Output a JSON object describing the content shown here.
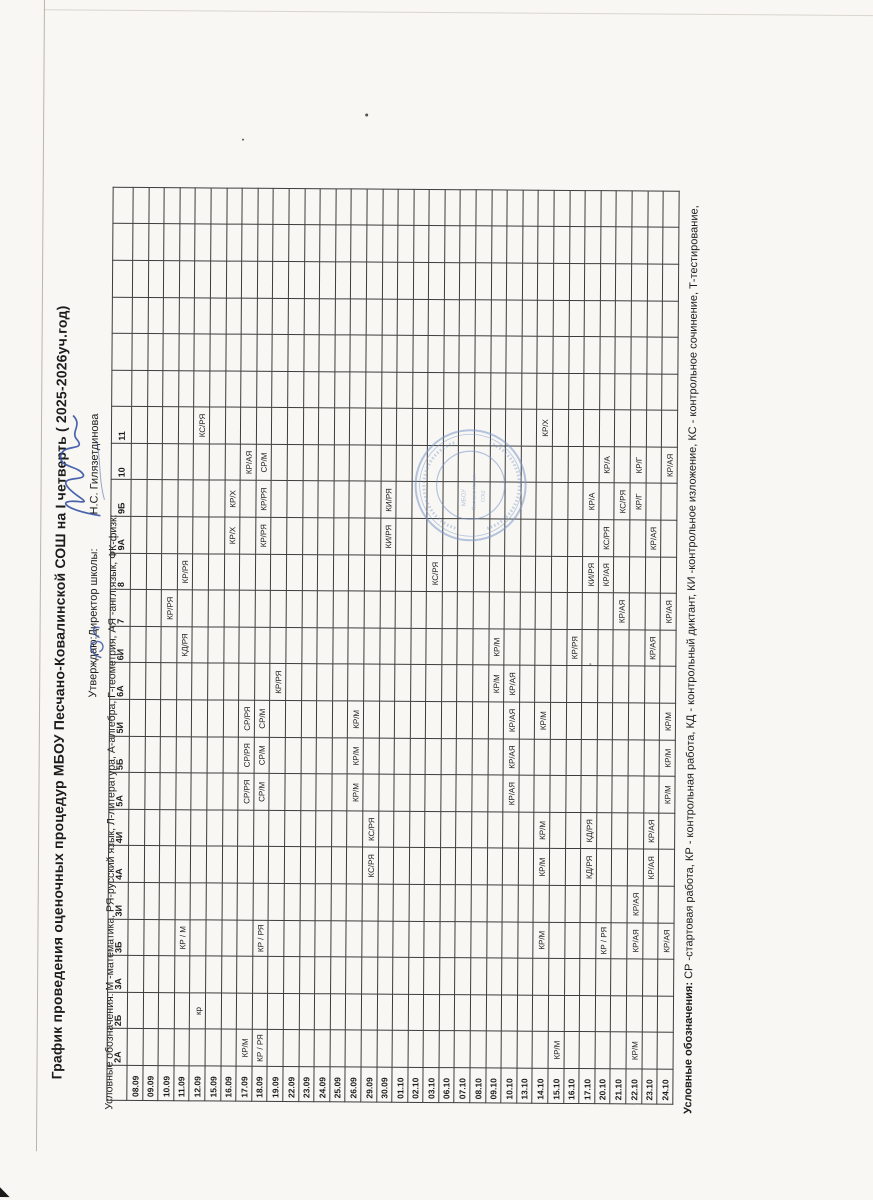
{
  "title": "График проведения оценочных процедур МБОУ Песчано-Ковалинской СОШ на I четверть ( 2025-2026уч.год)",
  "approval": {
    "prefix": "Утверждаю:Директор школы:",
    "name": "Н.С. Гилязетдинова"
  },
  "legend_top": "Условные обозначения: М -математика, РЯ-русский язык, Л-литература, А-алгебра, Г-геометрия, АЯ -англ.язык, ФК-физк:",
  "legend_bottom_bold": "Условные обозначения:",
  "legend_bottom_rest": " СР -стартовая работа, КР - контрольная работа, КД - контрольный диктант, КИ -контрольное изложение, КС - контрольное сочинение, Т-тестирование,",
  "classes": [
    "2А",
    "2Б",
    "3А",
    "3Б",
    "3И",
    "4А",
    "4И",
    "5А",
    "5Б",
    "5И",
    "6А",
    "6И",
    "7",
    "8",
    "9А",
    "9Б",
    "10",
    "11"
  ],
  "empty_trailing_columns": 6,
  "dates": [
    "08.09",
    "09.09",
    "10.09",
    "11.09",
    "12.09",
    "15.09",
    "16.09",
    "17.09",
    "18.09",
    "19.09",
    "22.09",
    "23.09",
    "24.09",
    "25.09",
    "26.09",
    "29.09",
    "30.09",
    "01.10",
    "02.10",
    "03.10",
    "06.10",
    "07.10",
    "08.10",
    "09.10",
    "10.10",
    "13.10",
    "14.10",
    "15.10",
    "16.10",
    "17.10",
    "20.10",
    "21.10",
    "22.10",
    "23.10",
    "24.10"
  ],
  "entries": [
    {
      "date": "10.09",
      "class": "7",
      "value": "КР/РЯ"
    },
    {
      "date": "11.09",
      "class": "3Б",
      "value": "КР / М"
    },
    {
      "date": "11.09",
      "class": "6И",
      "value": "КД/РЯ"
    },
    {
      "date": "11.09",
      "class": "8",
      "value": "КР/РЯ"
    },
    {
      "date": "12.09",
      "class": "2Б",
      "value": "кр"
    },
    {
      "date": "12.09",
      "class": "11",
      "value": "КС/РЯ"
    },
    {
      "date": "16.09",
      "class": "9А",
      "value": "КР/Х"
    },
    {
      "date": "16.09",
      "class": "9Б",
      "value": "КР/Х"
    },
    {
      "date": "17.09",
      "class": "2А",
      "value": "КР/М"
    },
    {
      "date": "17.09",
      "class": "5А",
      "value": "СР/РЯ"
    },
    {
      "date": "17.09",
      "class": "5Б",
      "value": "СР/РЯ"
    },
    {
      "date": "17.09",
      "class": "5И",
      "value": "СР/РЯ"
    },
    {
      "date": "17.09",
      "class": "10",
      "value": "КР/АЯ"
    },
    {
      "date": "18.09",
      "class": "2А",
      "value": "КР / РЯ"
    },
    {
      "date": "18.09",
      "class": "3Б",
      "value": "КР / РЯ"
    },
    {
      "date": "18.09",
      "class": "5А",
      "value": "СР/М"
    },
    {
      "date": "18.09",
      "class": "5Б",
      "value": "СР/М"
    },
    {
      "date": "18.09",
      "class": "5И",
      "value": "СР/М"
    },
    {
      "date": "18.09",
      "class": "9А",
      "value": "КР/РЯ"
    },
    {
      "date": "18.09",
      "class": "9Б",
      "value": "КР/РЯ"
    },
    {
      "date": "18.09",
      "class": "10",
      "value": "СР/М"
    },
    {
      "date": "19.09",
      "class": "6А",
      "value": "КР/РЯ"
    },
    {
      "date": "26.09",
      "class": "5А",
      "value": "КР/М"
    },
    {
      "date": "26.09",
      "class": "5Б",
      "value": "КР/М"
    },
    {
      "date": "26.09",
      "class": "5И",
      "value": "КР/М"
    },
    {
      "date": "29.09",
      "class": "4А",
      "value": "КС/РЯ"
    },
    {
      "date": "29.09",
      "class": "4И",
      "value": "КС/РЯ"
    },
    {
      "date": "30.09",
      "class": "9А",
      "value": "КИ/РЯ"
    },
    {
      "date": "30.09",
      "class": "9Б",
      "value": "КИ/РЯ"
    },
    {
      "date": "03.10",
      "class": "8",
      "value": "КС/РЯ"
    },
    {
      "date": "09.10",
      "class": "6А",
      "value": "КР/М"
    },
    {
      "date": "09.10",
      "class": "6И",
      "value": "КР/М"
    },
    {
      "date": "10.10",
      "class": "5А",
      "value": "КР/АЯ"
    },
    {
      "date": "10.10",
      "class": "5Б",
      "value": "КР/АЯ"
    },
    {
      "date": "10.10",
      "class": "5И",
      "value": "КР/АЯ"
    },
    {
      "date": "10.10",
      "class": "6А",
      "value": "КР/АЯ"
    },
    {
      "date": "14.10",
      "class": "3Б",
      "value": "КР/М"
    },
    {
      "date": "14.10",
      "class": "4А",
      "value": "КР/М"
    },
    {
      "date": "14.10",
      "class": "4И",
      "value": "КР/М"
    },
    {
      "date": "14.10",
      "class": "5И",
      "value": "КР/М"
    },
    {
      "date": "14.10",
      "class": "11",
      "value": "КР/Х"
    },
    {
      "date": "15.10",
      "class": "2А",
      "value": "КР/М"
    },
    {
      "date": "16.10",
      "class": "6И",
      "value": "КР/РЯ"
    },
    {
      "date": "17.10",
      "class": "4А",
      "value": "КД/РЯ"
    },
    {
      "date": "17.10",
      "class": "4И",
      "value": "КД/РЯ"
    },
    {
      "date": "17.10",
      "class": "8",
      "value": "КИ/РЯ"
    },
    {
      "date": "17.10",
      "class": "9Б",
      "value": "КР/А"
    },
    {
      "date": "20.10",
      "class": "3Б",
      "value": "КР / РЯ"
    },
    {
      "date": "20.10",
      "class": "8",
      "value": "КР/АЯ"
    },
    {
      "date": "20.10",
      "class": "9А",
      "value": "КС/РЯ"
    },
    {
      "date": "20.10",
      "class": "10",
      "value": "КР/А"
    },
    {
      "date": "21.10",
      "class": "7",
      "value": "КР/АЯ"
    },
    {
      "date": "21.10",
      "class": "9Б",
      "value": "КС/РЯ"
    },
    {
      "date": "22.10",
      "class": "2А",
      "value": "КР/М"
    },
    {
      "date": "22.10",
      "class": "3Б",
      "value": "КР/АЯ"
    },
    {
      "date": "22.10",
      "class": "3И",
      "value": "КР/АЯ"
    },
    {
      "date": "22.10",
      "class": "9Б",
      "value": "КР/Г"
    },
    {
      "date": "22.10",
      "class": "10",
      "value": "КР/Г"
    },
    {
      "date": "23.10",
      "class": "4А",
      "value": "КР/АЯ"
    },
    {
      "date": "23.10",
      "class": "4И",
      "value": "КР/АЯ"
    },
    {
      "date": "23.10",
      "class": "6И",
      "value": "КР/АЯ"
    },
    {
      "date": "23.10",
      "class": "9А",
      "value": "КР/АЯ"
    },
    {
      "date": "24.10",
      "class": "3Б",
      "value": "КР/АЯ"
    },
    {
      "date": "24.10",
      "class": "5А",
      "value": "КР/М"
    },
    {
      "date": "24.10",
      "class": "5Б",
      "value": "КР/М"
    },
    {
      "date": "24.10",
      "class": "5И",
      "value": "КР/М"
    },
    {
      "date": "24.10",
      "class": "7",
      "value": "КР/АЯ"
    },
    {
      "date": "24.10",
      "class": "10",
      "value": "КР/АЯ"
    }
  ],
  "stamp_color": "#7b97cc",
  "signature_color": "#3653a6"
}
